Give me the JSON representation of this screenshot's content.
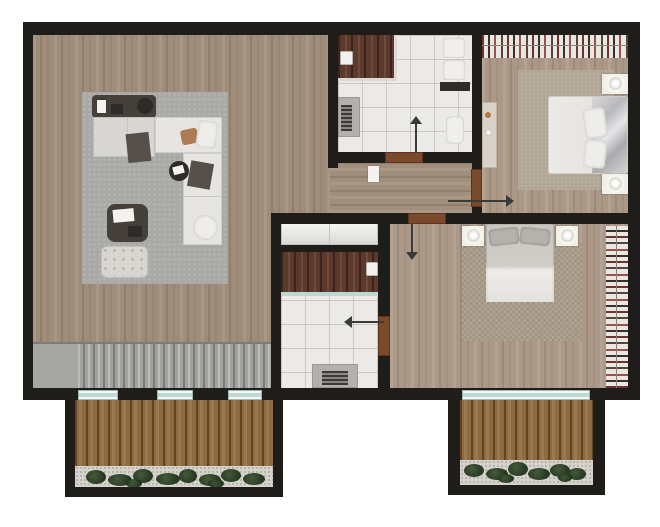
{
  "canvas": {
    "w": 660,
    "h": 527
  },
  "colors": {
    "background": "#ffffff",
    "wall": "#1f1d1a",
    "wood_living": "#9f8d7a",
    "wood_bedroom": "#ab9887",
    "wood_corridor": "#a18e7b",
    "tile": "#eceae6",
    "vanity_walnut": "#5d392b",
    "deck": "#8f6a3e",
    "glass": "#bcd8d2",
    "door": "#7b4a2c",
    "stairs": "#a2a2a0",
    "rug_living": "#a9a9a7",
    "rug_bedroom": "#b7ac9c",
    "plant": "#2e4425",
    "closet_white": "#f0f0ee",
    "bed_silver": "#c6c6c8"
  },
  "scene": [
    {
      "name": "base-floor",
      "cls": "wood-v",
      "x": 33,
      "y": 32,
      "w": 595,
      "h": 356,
      "z": 1
    },
    {
      "name": "corridor-floor",
      "cls": "wood-h",
      "x": 330,
      "y": 163,
      "w": 142,
      "h": 50,
      "z": 2
    },
    {
      "name": "bedroom1-floor",
      "cls": "wood-v2",
      "x": 482,
      "y": 32,
      "w": 146,
      "h": 181,
      "z": 2
    },
    {
      "name": "bedroom2-floor",
      "cls": "wood-v2",
      "x": 390,
      "y": 224,
      "w": 238,
      "h": 164,
      "z": 2
    },
    {
      "name": "bathroom1-floor",
      "cls": "tile",
      "x": 338,
      "y": 35,
      "w": 134,
      "h": 117,
      "z": 3
    },
    {
      "name": "bathroom2-floor",
      "cls": "tile",
      "x": 281,
      "y": 252,
      "w": 97,
      "h": 136,
      "z": 3
    },
    {
      "name": "hall-closet",
      "cls": "glossy",
      "x": 281,
      "y": 222,
      "w": 97,
      "h": 23,
      "z": 3
    },
    {
      "name": "hall-closet-seam",
      "cls": "seam",
      "x": 329,
      "y": 222,
      "w": 1,
      "h": 23,
      "z": 4
    },
    {
      "name": "stairs-landing",
      "cls": "stair-landing",
      "x": 33,
      "y": 343,
      "w": 45,
      "h": 45,
      "z": 6
    },
    {
      "name": "staircase-treads",
      "cls": "stairs",
      "x": 78,
      "y": 343,
      "w": 195,
      "h": 45,
      "z": 6
    },
    {
      "name": "stairs-top-edge",
      "cls": "edge",
      "x": 33,
      "y": 342,
      "w": 240,
      "h": 2,
      "z": 7
    },
    {
      "name": "living-rug",
      "cls": "rug-gray",
      "x": 82,
      "y": 92,
      "w": 146,
      "h": 192,
      "z": 7
    },
    {
      "name": "console-table",
      "cls": "dark1",
      "x": 92,
      "y": 95,
      "w": 64,
      "h": 23,
      "r": 4,
      "z": 10
    },
    {
      "name": "console-card",
      "cls": "white-card",
      "x": 97,
      "y": 100,
      "w": 9,
      "h": 13,
      "z": 11
    },
    {
      "name": "console-device",
      "cls": "dark2",
      "x": 111,
      "y": 104,
      "w": 12,
      "h": 10,
      "z": 11
    },
    {
      "name": "console-tray",
      "cls": "dark2",
      "x": 137,
      "y": 98,
      "w": 16,
      "h": 16,
      "r": "50%",
      "z": 11
    },
    {
      "name": "sofa-left-module",
      "cls": "sofa1",
      "x": 93,
      "y": 117,
      "w": 62,
      "h": 40,
      "z": 10
    },
    {
      "name": "sofa-chaise",
      "cls": "sofa2",
      "x": 155,
      "y": 117,
      "w": 67,
      "h": 36,
      "z": 10
    },
    {
      "name": "sofa-right-module",
      "cls": "sofa2",
      "x": 183,
      "y": 153,
      "w": 39,
      "h": 92,
      "z": 10
    },
    {
      "name": "sofa-seam",
      "cls": "seam",
      "x": 127,
      "y": 118,
      "w": 1,
      "h": 38,
      "z": 11
    },
    {
      "name": "sofa-seam-2",
      "cls": "seam",
      "x": 184,
      "y": 196,
      "w": 37,
      "h": 1,
      "z": 11
    },
    {
      "name": "sofa-cushion-tan",
      "cls": "cushion-tan",
      "x": 181,
      "y": 129,
      "w": 17,
      "h": 15,
      "rot": -12,
      "z": 11
    },
    {
      "name": "sofa-pillow-white",
      "cls": "pillow",
      "x": 197,
      "y": 121,
      "w": 20,
      "h": 27,
      "rot": 8,
      "z": 11
    },
    {
      "name": "sofa-throw",
      "cls": "dark3",
      "x": 127,
      "y": 133,
      "w": 23,
      "h": 29,
      "rot": -6,
      "z": 11
    },
    {
      "name": "sofa-pillow-dark",
      "cls": "dark3",
      "x": 189,
      "y": 162,
      "w": 23,
      "h": 26,
      "rot": 10,
      "z": 11
    },
    {
      "name": "sofa-pillow-round",
      "cls": "pillow",
      "x": 193,
      "y": 215,
      "w": 25,
      "h": 25,
      "r": "50%",
      "z": 11
    },
    {
      "name": "side-table",
      "cls": "dark2",
      "x": 169,
      "y": 161,
      "w": 20,
      "h": 20,
      "r": "50%",
      "z": 11
    },
    {
      "name": "side-table-papers",
      "cls": "white-card",
      "x": 173,
      "y": 166,
      "w": 11,
      "h": 8,
      "rot": -15,
      "z": 12
    },
    {
      "name": "coffee-table",
      "cls": "dark1",
      "x": 107,
      "y": 204,
      "w": 41,
      "h": 38,
      "r": 8,
      "z": 10
    },
    {
      "name": "coffee-table-book",
      "cls": "white-card",
      "x": 113,
      "y": 209,
      "w": 21,
      "h": 13,
      "rot": -5,
      "z": 11
    },
    {
      "name": "coffee-table-tray",
      "cls": "dark2",
      "x": 128,
      "y": 226,
      "w": 14,
      "h": 11,
      "z": 11
    },
    {
      "name": "ottoman",
      "cls": "tufted",
      "x": 101,
      "y": 246,
      "w": 47,
      "h": 32,
      "r": 6,
      "z": 10
    },
    {
      "name": "bath1-vanity",
      "cls": "walnut",
      "x": 338,
      "y": 35,
      "w": 58,
      "h": 45,
      "z": 10
    },
    {
      "name": "bath1-counter-edge-right",
      "cls": "counter-edge",
      "x": 394,
      "y": 35,
      "w": 3,
      "h": 46,
      "z": 11
    },
    {
      "name": "bath1-counter-edge-bottom",
      "cls": "counter-edge",
      "x": 338,
      "y": 78,
      "w": 59,
      "h": 3,
      "z": 11
    },
    {
      "name": "bath1-sink",
      "cls": "sink",
      "x": 340,
      "y": 51,
      "w": 13,
      "h": 14,
      "z": 12
    },
    {
      "name": "bath1-shower-tray",
      "cls": "shower",
      "x": 338,
      "y": 97,
      "w": 22,
      "h": 40,
      "z": 10
    },
    {
      "name": "bath1-shower-drain",
      "cls": "grate",
      "x": 341,
      "y": 105,
      "w": 11,
      "h": 26,
      "z": 11
    },
    {
      "name": "bath1-towel-1",
      "cls": "towel",
      "x": 443,
      "y": 38,
      "w": 22,
      "h": 20,
      "z": 10
    },
    {
      "name": "bath1-towel-2",
      "cls": "towel",
      "x": 443,
      "y": 60,
      "w": 22,
      "h": 20,
      "z": 10
    },
    {
      "name": "bath1-shelf",
      "cls": "dark2",
      "x": 440,
      "y": 82,
      "w": 30,
      "h": 9,
      "z": 10
    },
    {
      "name": "bath1-toilet",
      "cls": "towel",
      "x": 446,
      "y": 116,
      "w": 18,
      "h": 28,
      "r": 6,
      "z": 10
    },
    {
      "name": "bath2-vanity",
      "cls": "walnut",
      "x": 281,
      "y": 252,
      "w": 97,
      "h": 40,
      "z": 10
    },
    {
      "name": "bath2-sink",
      "cls": "sink",
      "x": 366,
      "y": 262,
      "w": 12,
      "h": 14,
      "z": 11
    },
    {
      "name": "bath2-glass-screen",
      "cls": "glass-line",
      "x": 281,
      "y": 292,
      "w": 97,
      "h": 4,
      "z": 11
    },
    {
      "name": "bath2-shower-tray",
      "cls": "shower",
      "x": 312,
      "y": 364,
      "w": 46,
      "h": 24,
      "z": 10
    },
    {
      "name": "bath2-shower-drain",
      "cls": "grate",
      "x": 322,
      "y": 371,
      "w": 26,
      "h": 14,
      "z": 11
    },
    {
      "name": "corridor-shelf",
      "cls": "white-card",
      "x": 368,
      "y": 166,
      "w": 11,
      "h": 16,
      "z": 10
    },
    {
      "name": "bedroom1-wardrobe",
      "cls": "clothes-v",
      "x": 482,
      "y": 34,
      "w": 146,
      "h": 24,
      "z": 10
    },
    {
      "name": "bedroom1-wardrobe-rail",
      "cls": "rail",
      "x": 482,
      "y": 45,
      "w": 146,
      "h": 1,
      "z": 11
    },
    {
      "name": "bedroom1-rug",
      "cls": "rug-beige",
      "x": 518,
      "y": 70,
      "w": 96,
      "h": 120,
      "z": 7
    },
    {
      "name": "bedroom1-dresser",
      "cls": "dresser",
      "x": 482,
      "y": 102,
      "w": 15,
      "h": 66,
      "z": 10
    },
    {
      "name": "dresser-decor-1",
      "cls": "decor-tan",
      "x": 485,
      "y": 112,
      "w": 6,
      "h": 6,
      "r": "50%",
      "z": 11
    },
    {
      "name": "dresser-decor-2",
      "cls": "white-card",
      "x": 486,
      "y": 130,
      "w": 5,
      "h": 5,
      "r": "50%",
      "z": 11
    },
    {
      "name": "bedroom1-bed",
      "cls": "bed-white",
      "x": 548,
      "y": 96,
      "w": 80,
      "h": 78,
      "r": 3,
      "z": 10
    },
    {
      "name": "bedroom1-bed-blanket",
      "cls": "silver",
      "x": 592,
      "y": 97,
      "w": 35,
      "h": 76,
      "z": 11
    },
    {
      "name": "bedroom1-bed-pillow-1",
      "cls": "pillow",
      "x": 584,
      "y": 108,
      "w": 22,
      "h": 30,
      "rot": -8,
      "z": 12
    },
    {
      "name": "bedroom1-bed-pillow-2",
      "cls": "pillow",
      "x": 584,
      "y": 140,
      "w": 22,
      "h": 28,
      "rot": 6,
      "z": 12
    },
    {
      "name": "bedroom1-nightstand-top",
      "cls": "nstand",
      "x": 602,
      "y": 74,
      "w": 26,
      "h": 20,
      "z": 10
    },
    {
      "name": "bedroom1-lamp-top",
      "cls": "lamp",
      "x": 609,
      "y": 77,
      "w": 13,
      "h": 13,
      "z": 11
    },
    {
      "name": "bedroom1-nightstand-bottom",
      "cls": "nstand",
      "x": 602,
      "y": 174,
      "w": 26,
      "h": 20,
      "z": 10
    },
    {
      "name": "bedroom1-lamp-bottom",
      "cls": "lamp",
      "x": 609,
      "y": 177,
      "w": 13,
      "h": 13,
      "z": 11
    },
    {
      "name": "bedroom2-rug",
      "cls": "rug-woven",
      "x": 462,
      "y": 243,
      "w": 120,
      "h": 98,
      "z": 7
    },
    {
      "name": "bedroom2-bed",
      "cls": "bed-gray",
      "x": 486,
      "y": 224,
      "w": 68,
      "h": 78,
      "r": 3,
      "z": 10
    },
    {
      "name": "bedroom2-pillow-left",
      "cls": "pillow-gray",
      "x": 489,
      "y": 228,
      "w": 30,
      "h": 17,
      "rot": -6,
      "z": 12
    },
    {
      "name": "bedroom2-pillow-right",
      "cls": "pillow-gray",
      "x": 520,
      "y": 228,
      "w": 30,
      "h": 17,
      "rot": 6,
      "z": 12
    },
    {
      "name": "bedroom2-blanket",
      "cls": "bed-whitefold",
      "x": 486,
      "y": 266,
      "w": 68,
      "h": 36,
      "z": 11
    },
    {
      "name": "bedroom2-nightstand-left",
      "cls": "nstand",
      "x": 462,
      "y": 226,
      "w": 22,
      "h": 20,
      "z": 10
    },
    {
      "name": "bedroom2-lamp-left",
      "cls": "lamp",
      "x": 467,
      "y": 229,
      "w": 13,
      "h": 13,
      "z": 11
    },
    {
      "name": "bedroom2-nightstand-right",
      "cls": "nstand",
      "x": 556,
      "y": 226,
      "w": 22,
      "h": 20,
      "z": 10
    },
    {
      "name": "bedroom2-lamp-right",
      "cls": "lamp",
      "x": 561,
      "y": 229,
      "w": 13,
      "h": 13,
      "z": 11
    },
    {
      "name": "bedroom2-wardrobe",
      "cls": "clothes-h",
      "x": 606,
      "y": 226,
      "w": 22,
      "h": 162,
      "z": 10
    },
    {
      "name": "bedroom2-wardrobe-rail",
      "cls": "rail",
      "x": 616,
      "y": 226,
      "w": 1,
      "h": 162,
      "z": 11
    },
    {
      "name": "balcony-left-deck",
      "cls": "deck",
      "x": 75,
      "y": 400,
      "w": 198,
      "h": 87,
      "z": 5
    },
    {
      "name": "balcony-left-planting",
      "cls": "gravel",
      "x": 75,
      "y": 466,
      "w": 198,
      "h": 21,
      "z": 8
    },
    {
      "name": "balcony-right-deck",
      "cls": "deck",
      "x": 460,
      "y": 400,
      "w": 133,
      "h": 85,
      "z": 5
    },
    {
      "name": "balcony-right-planting",
      "cls": "gravel",
      "x": 460,
      "y": 460,
      "w": 133,
      "h": 25,
      "z": 8
    },
    {
      "name": "plant-1",
      "cls": "plant",
      "x": 86,
      "y": 470,
      "w": 20,
      "h": 14,
      "z": 9
    },
    {
      "name": "plant-2",
      "cls": "plant",
      "x": 108,
      "y": 474,
      "w": 24,
      "h": 12,
      "z": 9
    },
    {
      "name": "plant-3",
      "cls": "plant",
      "x": 133,
      "y": 469,
      "w": 20,
      "h": 14,
      "z": 9
    },
    {
      "name": "plant-4",
      "cls": "plant",
      "x": 156,
      "y": 473,
      "w": 24,
      "h": 12,
      "z": 9
    },
    {
      "name": "plant-5",
      "cls": "plant",
      "x": 179,
      "y": 469,
      "w": 18,
      "h": 14,
      "z": 9
    },
    {
      "name": "plant-6",
      "cls": "plant",
      "x": 199,
      "y": 474,
      "w": 22,
      "h": 12,
      "z": 9
    },
    {
      "name": "plant-7",
      "cls": "plant",
      "x": 221,
      "y": 469,
      "w": 20,
      "h": 13,
      "z": 9
    },
    {
      "name": "plant-8",
      "cls": "plant",
      "x": 243,
      "y": 473,
      "w": 22,
      "h": 12,
      "z": 9
    },
    {
      "name": "plant-9",
      "cls": "plant",
      "x": 126,
      "y": 479,
      "w": 16,
      "h": 9,
      "z": 9
    },
    {
      "name": "plant-10",
      "cls": "plant",
      "x": 208,
      "y": 479,
      "w": 16,
      "h": 9,
      "z": 9
    },
    {
      "name": "plant-11",
      "cls": "plant",
      "x": 464,
      "y": 464,
      "w": 20,
      "h": 13,
      "z": 9
    },
    {
      "name": "plant-12",
      "cls": "plant",
      "x": 486,
      "y": 468,
      "w": 22,
      "h": 12,
      "z": 9
    },
    {
      "name": "plant-13",
      "cls": "plant",
      "x": 508,
      "y": 462,
      "w": 20,
      "h": 14,
      "z": 9
    },
    {
      "name": "plant-14",
      "cls": "plant",
      "x": 528,
      "y": 468,
      "w": 22,
      "h": 12,
      "z": 9
    },
    {
      "name": "plant-15",
      "cls": "plant",
      "x": 550,
      "y": 464,
      "w": 20,
      "h": 13,
      "z": 9
    },
    {
      "name": "plant-16",
      "cls": "plant",
      "x": 568,
      "y": 468,
      "w": 18,
      "h": 12,
      "z": 9
    },
    {
      "name": "plant-17",
      "cls": "plant",
      "x": 498,
      "y": 474,
      "w": 16,
      "h": 9,
      "z": 9
    },
    {
      "name": "plant-18",
      "cls": "plant",
      "x": 558,
      "y": 473,
      "w": 14,
      "h": 9,
      "z": 9
    },
    {
      "name": "wall-top",
      "cls": "wall",
      "x": 23,
      "y": 22,
      "w": 617,
      "h": 13,
      "z": 30
    },
    {
      "name": "wall-left",
      "cls": "wall",
      "x": 23,
      "y": 22,
      "w": 10,
      "h": 378,
      "z": 30
    },
    {
      "name": "wall-right",
      "cls": "wall",
      "x": 628,
      "y": 22,
      "w": 12,
      "h": 378,
      "z": 30
    },
    {
      "name": "wall-bottom",
      "cls": "wall",
      "x": 23,
      "y": 388,
      "w": 617,
      "h": 12,
      "z": 30
    },
    {
      "name": "wall-bath1-west",
      "cls": "wall",
      "x": 328,
      "y": 22,
      "w": 10,
      "h": 146,
      "z": 30
    },
    {
      "name": "wall-bath1-south-left",
      "cls": "wall",
      "x": 328,
      "y": 152,
      "w": 57,
      "h": 11,
      "z": 30
    },
    {
      "name": "wall-bath1-south-right",
      "cls": "wall",
      "x": 423,
      "y": 152,
      "w": 59,
      "h": 11,
      "z": 30
    },
    {
      "name": "wall-bedroom1-west",
      "cls": "wall",
      "x": 472,
      "y": 22,
      "w": 10,
      "h": 148,
      "z": 30
    },
    {
      "name": "wall-bedroom1-west-stub",
      "cls": "wall",
      "x": 472,
      "y": 207,
      "w": 10,
      "h": 8,
      "z": 30
    },
    {
      "name": "wall-bedrooms-divider-left",
      "cls": "wall",
      "x": 271,
      "y": 213,
      "w": 137,
      "h": 11,
      "z": 30
    },
    {
      "name": "wall-bedrooms-divider-right",
      "cls": "wall",
      "x": 446,
      "y": 213,
      "w": 186,
      "h": 11,
      "z": 30
    },
    {
      "name": "wall-midblock-west",
      "cls": "wall",
      "x": 271,
      "y": 213,
      "w": 10,
      "h": 175,
      "z": 30
    },
    {
      "name": "wall-midblock-split",
      "cls": "wall",
      "x": 281,
      "y": 245,
      "w": 107,
      "h": 7,
      "z": 30
    },
    {
      "name": "wall-midblock-east-upper",
      "cls": "wall",
      "x": 378,
      "y": 224,
      "w": 12,
      "h": 92,
      "z": 30
    },
    {
      "name": "wall-midblock-east-lower",
      "cls": "wall",
      "x": 378,
      "y": 356,
      "w": 12,
      "h": 32,
      "z": 30
    },
    {
      "name": "balcony-left-wall-west",
      "cls": "wall",
      "x": 65,
      "y": 400,
      "w": 10,
      "h": 97,
      "z": 30
    },
    {
      "name": "balcony-left-wall-east",
      "cls": "wall",
      "x": 273,
      "y": 400,
      "w": 10,
      "h": 97,
      "z": 30
    },
    {
      "name": "balcony-left-wall-south",
      "cls": "wall",
      "x": 65,
      "y": 487,
      "w": 218,
      "h": 10,
      "z": 30
    },
    {
      "name": "balcony-right-wall-west",
      "cls": "wall",
      "x": 448,
      "y": 400,
      "w": 12,
      "h": 95,
      "z": 30
    },
    {
      "name": "balcony-right-wall-east",
      "cls": "wall",
      "x": 593,
      "y": 400,
      "w": 12,
      "h": 95,
      "z": 30
    },
    {
      "name": "balcony-right-wall-south",
      "cls": "wall",
      "x": 448,
      "y": 485,
      "w": 157,
      "h": 10,
      "z": 30
    },
    {
      "name": "window-1",
      "cls": "glass",
      "x": 78,
      "y": 390,
      "w": 40,
      "h": 10,
      "z": 35
    },
    {
      "name": "window-2",
      "cls": "glass",
      "x": 157,
      "y": 390,
      "w": 36,
      "h": 10,
      "z": 35
    },
    {
      "name": "window-3",
      "cls": "glass",
      "x": 228,
      "y": 390,
      "w": 34,
      "h": 10,
      "z": 35
    },
    {
      "name": "sliding-door-glazing",
      "cls": "glass",
      "x": 462,
      "y": 390,
      "w": 128,
      "h": 10,
      "z": 35
    },
    {
      "name": "bath1-door",
      "cls": "door",
      "x": 385,
      "y": 152,
      "w": 38,
      "h": 11,
      "z": 40
    },
    {
      "name": "bath1-door-arrow",
      "cls": "arrow-line",
      "x": 415,
      "y": 118,
      "w": 2,
      "h": 34,
      "z": 40
    },
    {
      "name": "bath1-door-arrowhead",
      "cls": "tri tri-up",
      "x": 410,
      "y": 110,
      "z": 40
    },
    {
      "name": "bedroom1-door",
      "cls": "door",
      "x": 471,
      "y": 169,
      "w": 11,
      "h": 38,
      "z": 40
    },
    {
      "name": "bedroom1-door-arrow",
      "cls": "arrow-line",
      "x": 448,
      "y": 200,
      "w": 60,
      "h": 2,
      "z": 40
    },
    {
      "name": "bedroom1-door-arrowhead",
      "cls": "tri tri-right",
      "x": 506,
      "y": 195,
      "z": 40
    },
    {
      "name": "bedroom2-door",
      "cls": "door",
      "x": 408,
      "y": 213,
      "w": 38,
      "h": 11,
      "z": 40
    },
    {
      "name": "bedroom2-door-arrow",
      "cls": "arrow-line",
      "x": 411,
      "y": 224,
      "w": 2,
      "h": 30,
      "z": 40
    },
    {
      "name": "bedroom2-door-arrowhead",
      "cls": "tri tri-down",
      "x": 406,
      "y": 252,
      "z": 40
    },
    {
      "name": "bath2-door",
      "cls": "door",
      "x": 378,
      "y": 316,
      "w": 12,
      "h": 40,
      "z": 40
    },
    {
      "name": "bath2-door-arrow",
      "cls": "arrow-line",
      "x": 346,
      "y": 321,
      "w": 38,
      "h": 2,
      "z": 40
    },
    {
      "name": "bath2-door-arrowhead",
      "cls": "tri tri-left",
      "x": 338,
      "y": 316,
      "z": 40
    }
  ]
}
